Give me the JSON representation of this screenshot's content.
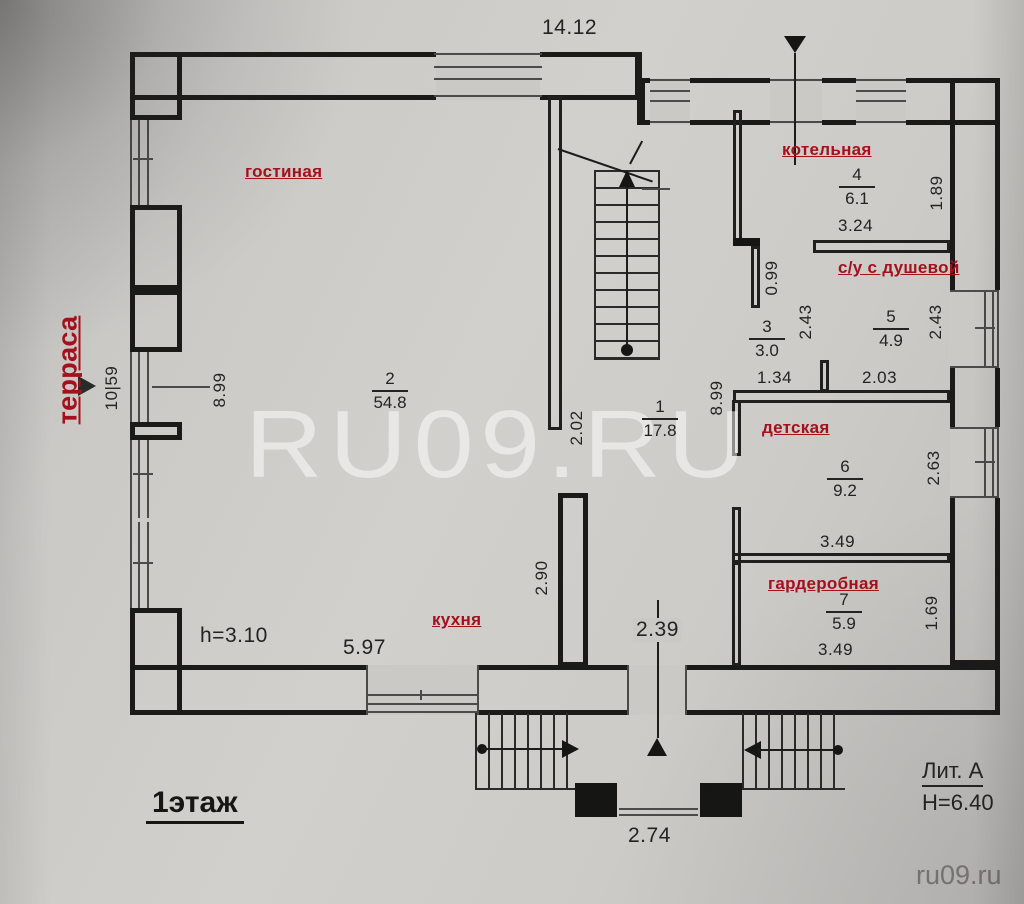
{
  "document": {
    "floor_title": "1этаж",
    "building_liter": "Лит. А",
    "building_height": "H=6.40",
    "ceiling_height": "h=3.10",
    "watermark_large": "RU09.RU",
    "watermark_small": "ru09.ru"
  },
  "rooms": {
    "living": {
      "name": "гостиная",
      "number": "2",
      "area": "54.8"
    },
    "hall": {
      "number": "1",
      "area": "17.8"
    },
    "corridor": {
      "number": "3",
      "area": "3.0"
    },
    "boiler": {
      "name": "котельная",
      "number": "4",
      "area": "6.1"
    },
    "bath": {
      "name": "с/у с душевой",
      "number": "5",
      "area": "4.9"
    },
    "kids": {
      "name": "детская",
      "number": "6",
      "area": "9.2"
    },
    "wardrobe": {
      "name": "гардеробная",
      "number": "7",
      "area": "5.9"
    },
    "kitchen": {
      "name": "кухня"
    },
    "terrace": {
      "name": "терраса"
    }
  },
  "dims": {
    "top_width": "14.12",
    "boiler_depth": "1.89",
    "boiler_width": "3.24",
    "boiler_wall_stub": "0.99",
    "bath_left_depth": "2.43",
    "bath_right_depth": "2.43",
    "corridor_opening": "1.34",
    "bath_width": "2.03",
    "right_wing_depth": "8.99",
    "living_depth": "8.99",
    "terrace_length": "10|59",
    "hall_width_upper": "2.02",
    "kids_depth": "2.63",
    "kids_width": "3.49",
    "wardrobe_depth": "1.69",
    "wardrobe_width": "3.49",
    "kitchen_opening": "2.90",
    "hall_width_lower": "2.39",
    "kitchen_window_width": "5.97",
    "porch_width": "2.74"
  }
}
